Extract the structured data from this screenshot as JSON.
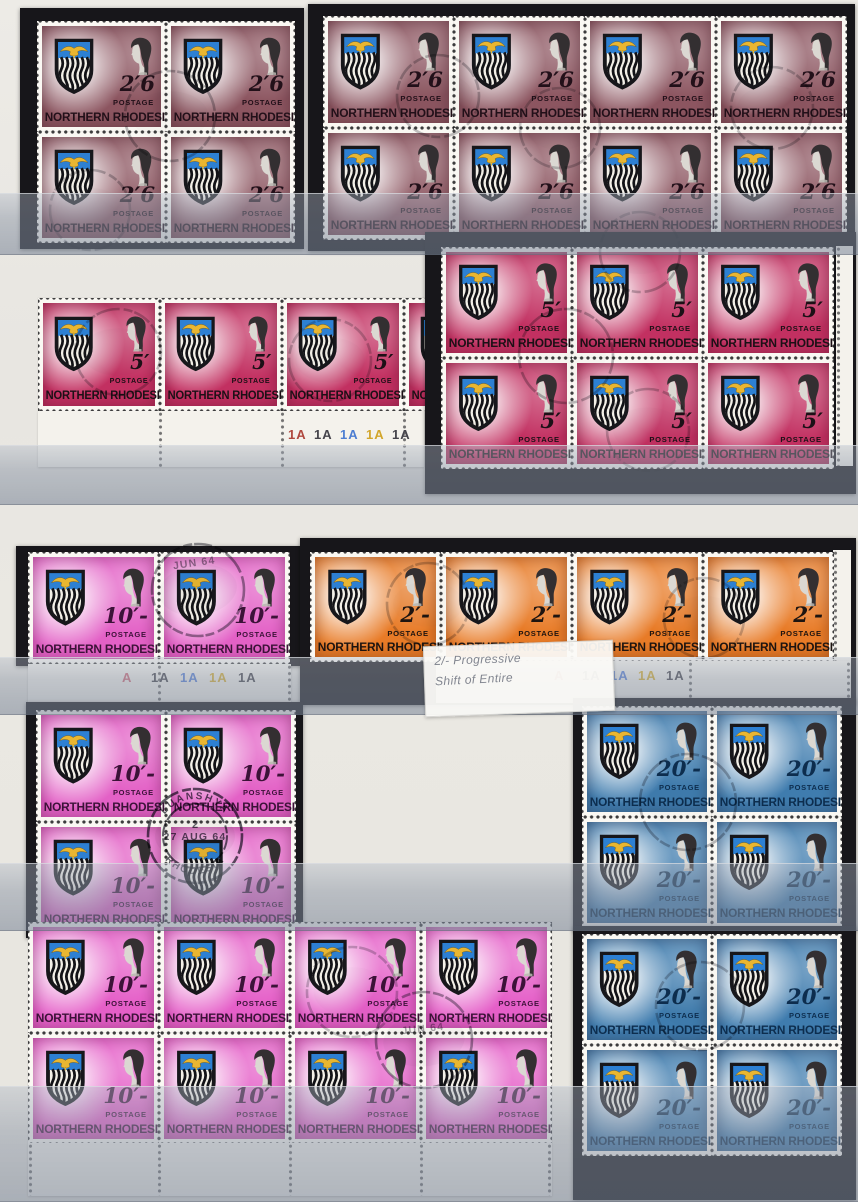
{
  "page": {
    "kind": "stamp stockbook page",
    "colors": {
      "page_bg": "#e8e6e1",
      "mount_card": "#17161a",
      "film_tint": "rgba(136,147,164,0.5)",
      "selvage": "#f4f2ec"
    }
  },
  "stamp_design": {
    "country": "NORTHERN RHODESIA",
    "postage_label": "POSTAGE",
    "portrait": "Queen Elizabeth II",
    "arms": {
      "field_blue": "#2d80d3",
      "eagle_gold": "#e9b631",
      "shield_outline": "#17171b"
    }
  },
  "denominations_on_page": [
    "2/6",
    "5/-",
    "10/-",
    "2/-",
    "20/-"
  ],
  "cards": [
    {
      "x": 20,
      "y": 8,
      "w": 284,
      "h": 241
    },
    {
      "x": 308,
      "y": 4,
      "w": 547,
      "h": 247
    },
    {
      "x": 425,
      "y": 232,
      "w": 431,
      "h": 262
    },
    {
      "x": 16,
      "y": 546,
      "w": 290,
      "h": 120
    },
    {
      "x": 300,
      "y": 538,
      "w": 556,
      "h": 167
    },
    {
      "x": 26,
      "y": 702,
      "w": 277,
      "h": 236
    },
    {
      "x": 573,
      "y": 698,
      "w": 283,
      "h": 233
    },
    {
      "x": 573,
      "y": 926,
      "w": 283,
      "h": 274
    }
  ],
  "side_margins": [
    {
      "x": 836,
      "y": 246,
      "w": 17,
      "h": 220
    },
    {
      "x": 833,
      "y": 550,
      "w": 18,
      "h": 152
    }
  ],
  "blocks": [
    {
      "id": "2s6d-block-of-4",
      "value": "2/6",
      "display": "2′6",
      "color": "#8c5560",
      "country_color": "#221019",
      "grid": {
        "x": 37,
        "y": 21,
        "cols": 2,
        "rows": 2,
        "sw": 129,
        "sh": 111
      }
    },
    {
      "id": "2s6d-block-of-8",
      "value": "2/6",
      "display": "2′6",
      "color": "#8c5560",
      "country_color": "#221019",
      "grid": {
        "x": 323,
        "y": 16,
        "cols": 4,
        "rows": 2,
        "sw": 131,
        "sh": 112
      }
    },
    {
      "id": "5s-marginal-strip",
      "value": "5/-",
      "display": "5′",
      "color": "#c23061",
      "country_color": "#1c1016",
      "grid": {
        "x": 38,
        "y": 298,
        "cols": 4,
        "rows": 1,
        "sw": 122,
        "sh": 113
      },
      "margin": {
        "x": 38,
        "y": 411,
        "w": 386,
        "h": 56,
        "set": 0,
        "label_x": 250,
        "label_y": 16,
        "label_gap": 26,
        "vperf": [
          122,
          244,
          366
        ]
      }
    },
    {
      "id": "5s-block-of-6",
      "value": "5/-",
      "display": "5′",
      "color": "#c23061",
      "country_color": "#1c1016",
      "grid": {
        "x": 441,
        "y": 247,
        "cols": 3,
        "rows": 2,
        "sw": 131,
        "sh": 111
      }
    },
    {
      "id": "10s-marginal-pair",
      "value": "10/-",
      "display": "10′-",
      "color": "#e361c6",
      "country_color": "#3c1238",
      "grid": {
        "x": 28,
        "y": 552,
        "cols": 2,
        "rows": 1,
        "sw": 131,
        "sh": 112
      },
      "margin": {
        "x": 28,
        "y": 664,
        "w": 263,
        "h": 42,
        "set": 1,
        "label_x": 94,
        "label_y": 6,
        "label_gap": 29,
        "vperf": [
          131,
          261
        ]
      }
    },
    {
      "id": "2s-marginal-strip-of-4",
      "value": "2/-",
      "display": "2′-",
      "color": "#e87b27",
      "country_color": "#1d1410",
      "grid": {
        "x": 310,
        "y": 552,
        "cols": 4,
        "rows": 1,
        "sw": 131,
        "sh": 110
      },
      "margin": {
        "x": 436,
        "y": 661,
        "w": 414,
        "h": 42,
        "set": 2,
        "label_x": 118,
        "label_y": 7,
        "label_gap": 28,
        "vperf": [
          254,
          412
        ]
      }
    },
    {
      "id": "10s-block-of-4",
      "value": "10/-",
      "display": "10′-",
      "color": "#e361c6",
      "country_color": "#3c1238",
      "grid": {
        "x": 36,
        "y": 710,
        "cols": 2,
        "rows": 2,
        "sw": 130,
        "sh": 112
      }
    },
    {
      "id": "20s-block-of-4-upper",
      "value": "20/-",
      "display": "20′-",
      "color": "#3f7cae",
      "country_color": "#0d2d4e",
      "grid": {
        "x": 582,
        "y": 706,
        "cols": 2,
        "rows": 2,
        "sw": 130,
        "sh": 111
      }
    },
    {
      "id": "10s-marginal-block-of-8",
      "value": "10/-",
      "display": "10′-",
      "color": "#e55fc8",
      "country_color": "#3c1238",
      "grid": {
        "x": 28,
        "y": 922,
        "cols": 4,
        "rows": 2,
        "sw": 131,
        "sh": 111
      },
      "margin": {
        "x": 28,
        "y": 1143,
        "w": 524,
        "h": 53,
        "set": -1,
        "vperf": [
          2,
          131,
          262,
          393,
          521
        ]
      }
    },
    {
      "id": "20s-block-of-4-lower",
      "value": "20/-",
      "display": "20′-",
      "color": "#3f7cae",
      "country_color": "#0d2d4e",
      "grid": {
        "x": 582,
        "y": 934,
        "cols": 2,
        "rows": 2,
        "sw": 130,
        "sh": 111
      }
    }
  ],
  "plate_sets": [
    {
      "labels": [
        {
          "text": "1A",
          "color": "#b0493f"
        },
        {
          "text": "1A",
          "color": "#45444b"
        },
        {
          "text": "1A",
          "color": "#4d7ed2"
        },
        {
          "text": "1A",
          "color": "#d2a62c"
        },
        {
          "text": "1A",
          "color": "#45444b"
        }
      ]
    },
    {
      "labels": [
        {
          "text": "A",
          "color": "#d06a78"
        },
        {
          "text": "1A",
          "color": "#45444b"
        },
        {
          "text": "1A",
          "color": "#567fd6"
        },
        {
          "text": "1A",
          "color": "#d8af31"
        },
        {
          "text": "1A",
          "color": "#45444b"
        }
      ]
    },
    {
      "labels": [
        {
          "text": "A",
          "color": "#c24b44"
        },
        {
          "text": "1A",
          "color": "#45444b"
        },
        {
          "text": "1A",
          "color": "#567fd6"
        },
        {
          "text": "1A",
          "color": "#d8af31"
        },
        {
          "text": "1A",
          "color": "#45444b"
        }
      ]
    }
  ],
  "note": {
    "line1": "2/- Progressive",
    "line2": "Shift of Entire"
  },
  "postmarks": [
    {
      "cx": 195,
      "cy": 836,
      "r": 47,
      "r2": 32,
      "top_text": "LUANSHYA",
      "office_num": "2",
      "date": "27 AUG 64",
      "bottom_text": "RHODESIA",
      "opacity": 0.78
    },
    {
      "cx": 198,
      "cy": 590,
      "r": 46,
      "date": "JUN 64",
      "date_dy": -28,
      "rot": -8,
      "opacity": 0.5
    },
    {
      "cx": 424,
      "cy": 1040,
      "r": 48,
      "date": "JUN 64",
      "date_dy": -12,
      "rot": -6,
      "opacity": 0.45
    },
    {
      "cx": 170,
      "cy": 116,
      "r": 45,
      "opacity": 0.33
    },
    {
      "cx": 438,
      "cy": 96,
      "r": 41,
      "opacity": 0.3
    },
    {
      "cx": 560,
      "cy": 128,
      "r": 40,
      "opacity": 0.26
    },
    {
      "cx": 772,
      "cy": 108,
      "r": 41,
      "opacity": 0.28
    },
    {
      "cx": 118,
      "cy": 352,
      "r": 43,
      "opacity": 0.3
    },
    {
      "cx": 330,
      "cy": 360,
      "r": 41,
      "opacity": 0.26
    },
    {
      "cx": 566,
      "cy": 356,
      "r": 47,
      "opacity": 0.33
    },
    {
      "cx": 648,
      "cy": 430,
      "r": 41,
      "opacity": 0.28
    },
    {
      "cx": 428,
      "cy": 604,
      "r": 41,
      "opacity": 0.28
    },
    {
      "cx": 704,
      "cy": 618,
      "r": 40,
      "opacity": 0.26
    },
    {
      "cx": 688,
      "cy": 802,
      "r": 48,
      "opacity": 0.33
    },
    {
      "cx": 700,
      "cy": 1006,
      "r": 44,
      "opacity": 0.3
    },
    {
      "cx": 352,
      "cy": 992,
      "r": 45,
      "opacity": 0.28
    },
    {
      "cx": 640,
      "cy": 252,
      "r": 40,
      "opacity": 0.3
    },
    {
      "cx": 90,
      "cy": 210,
      "r": 40,
      "opacity": 0.3
    }
  ],
  "films": [
    {
      "y": 193,
      "h": 60
    },
    {
      "y": 445,
      "h": 58
    },
    {
      "y": 657,
      "h": 56
    },
    {
      "y": 863,
      "h": 66
    },
    {
      "y": 1086,
      "h": 114
    }
  ],
  "note_box": {
    "x": 424,
    "y": 643,
    "w": 172,
    "h": 58
  }
}
